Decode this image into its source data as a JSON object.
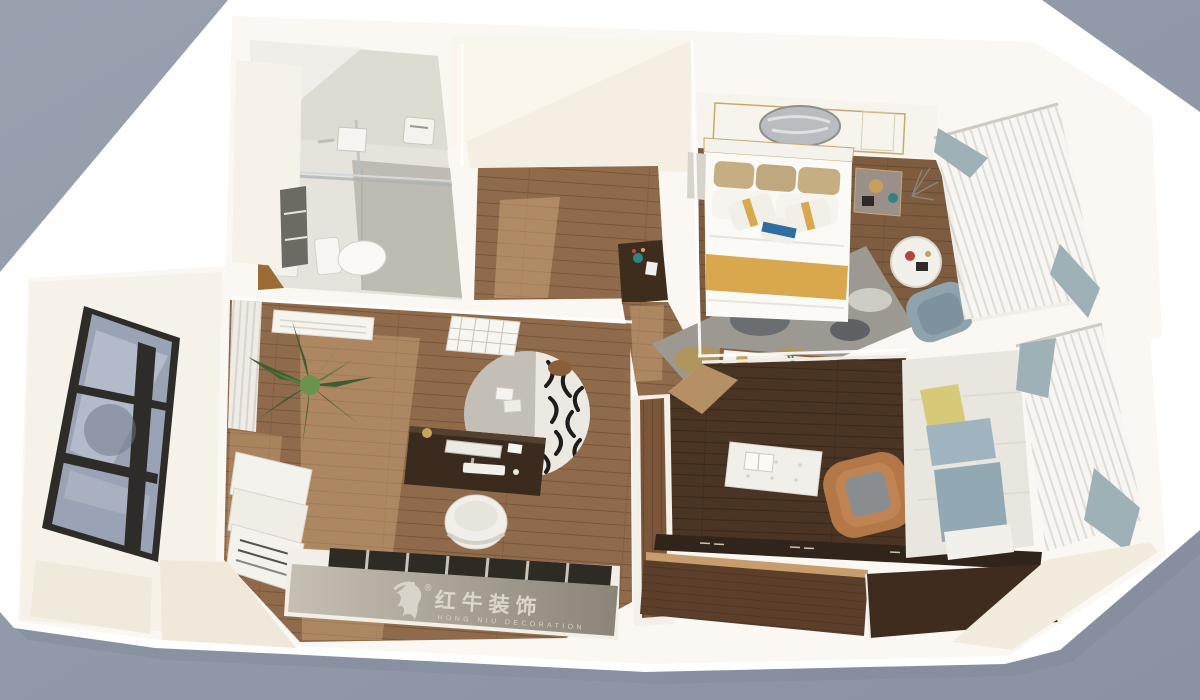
{
  "watermark": {
    "logo_cn": "红牛装饰",
    "logo_en": "HONG NIU DECORATION",
    "registered": "®",
    "logo_icon": "bull-icon",
    "logo_color": "#D9D4CA"
  },
  "colors": {
    "background": "#939BAA",
    "drop_shadow": "#7E8798",
    "ground_glow": "#FFFFFF",
    "wall_top_white": "#FBF8F3",
    "wall_cream": "#F3ECDE",
    "wall_cream_deep": "#E9E0CC",
    "bath_tile_wall": "#DEDBD2",
    "bath_tile_floor": "#C2C0B7",
    "floor_oak": "#8F6B4B",
    "floor_oak_bedroom": "#7D5C3F",
    "floor_walnut": "#4A3423",
    "tv_console_dark": "#31241A",
    "wood_partition": "#7B5638",
    "trim_gold": "#C9A96B",
    "bed_runner_gold": "#D9A84E",
    "pillow_tan": "#C6AE83",
    "pillow_accent_blue": "#2F6E9E",
    "drape_sage": "#9DB1B7",
    "sheer_white": "#F7F6F3",
    "leather_tan": "#B47748",
    "pillow_yellow": "#D6CA78",
    "pillow_blue_gray": "#9FB4BE",
    "vase_teal": "#2E8584",
    "plant_green": "#4C6A3A",
    "window_glass": "#9AA3B5",
    "window_frame": "#2E2C28",
    "rug_camo_gray": "#9B9991",
    "rug_zebra_black": "#1F1D1B"
  }
}
